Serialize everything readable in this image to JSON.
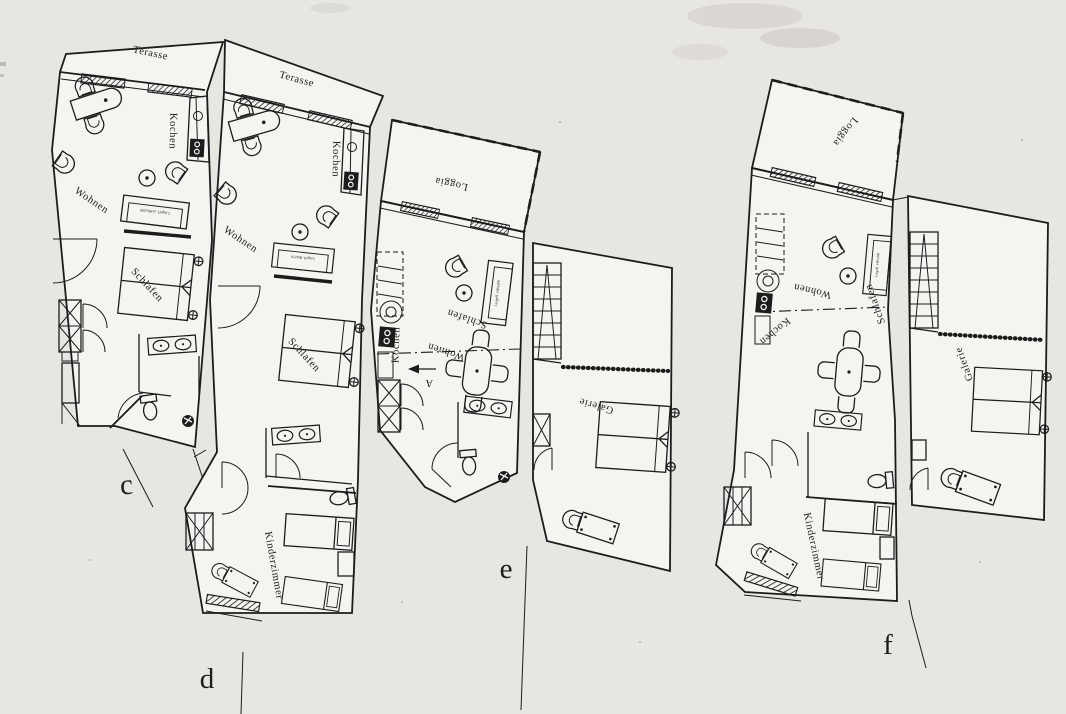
{
  "document": {
    "type": "scanned floor plan sheet",
    "units_shown": 4
  },
  "colors": {
    "paper": "#e8e6e2",
    "interior": "#f6f4f0",
    "ink": "#1c1c1c"
  },
  "plans": {
    "c": {
      "letter": "c",
      "terasse": "Terasse",
      "kochen": "Kochen",
      "wohnen": "Wohnen",
      "schlafen": "Schlafen",
      "sofa_note": "Liegefl. 2x90x200"
    },
    "d": {
      "letter": "d",
      "terasse": "Terasse",
      "kochen": "Kochen",
      "wohnen": "Wohnen",
      "schlafen": "Schlafen",
      "kinderzimmer": "Kinderzimmer",
      "sofa_note": "Liegefl. 80x210"
    },
    "e": {
      "letter": "e",
      "loggia": "Loggia",
      "kochen": "Kochen",
      "wohnen": "Wohnen",
      "schlafen": "Schlafen",
      "galerie": "Galerie",
      "entry_arrow": "A",
      "sofa_note": "Liegefl. 140x200"
    },
    "f": {
      "letter": "f",
      "loggia": "Loggia",
      "kochen": "Kochen",
      "wohnen": "Wohnen",
      "schlafen": "Schlafen",
      "galerie": "Galerie",
      "kinderzimmer": "Kinderzimmer",
      "sofa_note": "Liegefl. 140x200"
    }
  }
}
